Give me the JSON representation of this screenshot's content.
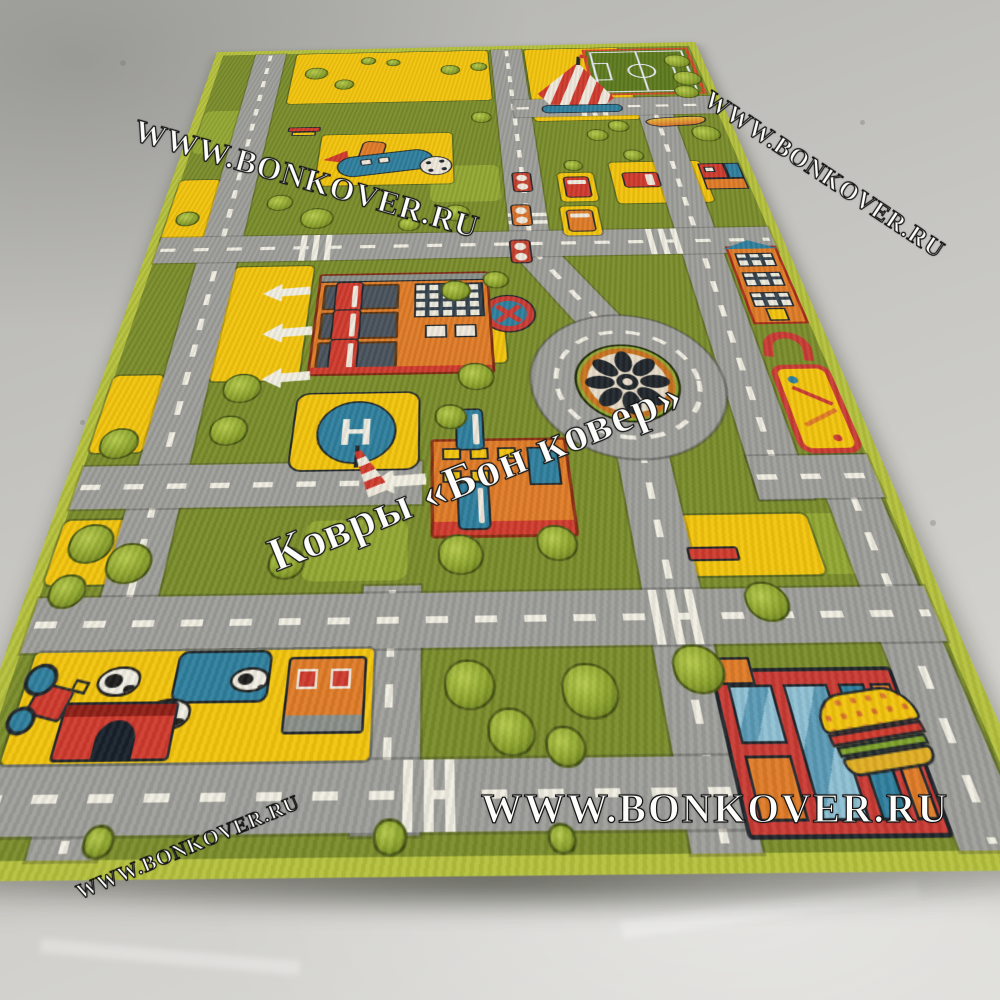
{
  "photo": {
    "subject": "children's city road play rug on concrete floor",
    "helipad_letter": "H"
  },
  "watermarks": {
    "site": "WWW.BONKOVER.RU",
    "brand": "Ковры «Бон ковер»"
  },
  "colors": {
    "floor": "#c6c5c1",
    "floor-dark": "#b2b2ae",
    "floor-light": "#d4d3cf",
    "rug-edge": "#b5c13d",
    "grass": "#7a8c2b",
    "grass-light": "#93a733",
    "road": "#9d9d99",
    "dash": "#f0ede2",
    "yellow": "#f2c40d",
    "orange": "#df7b27",
    "red": "#cf3a2d",
    "teal": "#2f7f9d",
    "navy": "#203c4e",
    "tree-dark": "#5f7419",
    "tree-mid": "#8ca32c",
    "tree-light": "#b7cb4d",
    "field-green": "#5d7a1e"
  },
  "features": [
    "carousel",
    "airplane",
    "football-field",
    "traffic-light",
    "truck",
    "no-stopping-sign",
    "roundabout",
    "fire-station",
    "arrow",
    "helipad",
    "windsock",
    "school",
    "goal",
    "playground",
    "house",
    "taxi-garage",
    "car",
    "farm",
    "pond",
    "cow",
    "barn",
    "tractor",
    "cafe",
    "burger",
    "bench",
    "tree",
    "crosswalk",
    "road"
  ]
}
